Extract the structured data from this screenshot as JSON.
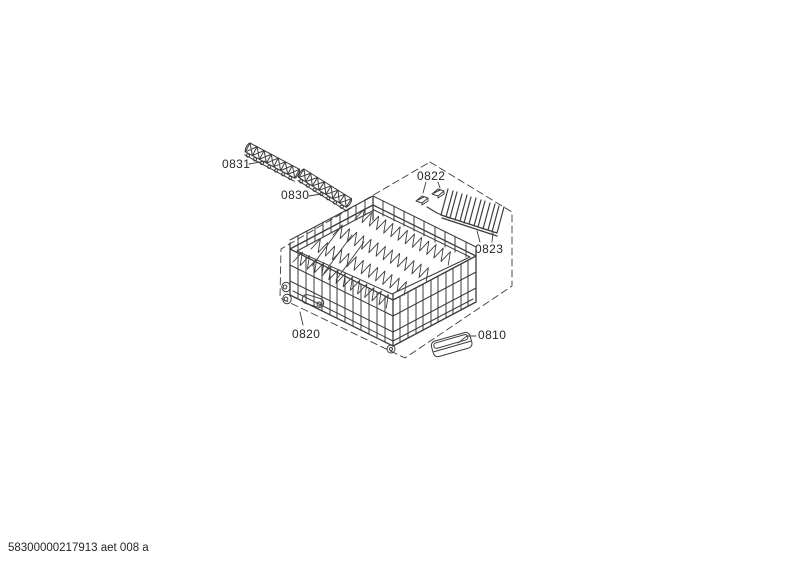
{
  "diagram": {
    "background_color": "#ffffff",
    "line_color": "#3c3c3c",
    "label_color": "#262626",
    "boundary_style": "dashed",
    "parts": [
      {
        "code": "0831"
      },
      {
        "code": "0830"
      },
      {
        "code": "0822"
      },
      {
        "code": "0823"
      },
      {
        "code": "0820"
      },
      {
        "code": "0810"
      }
    ]
  },
  "footer": {
    "document_number": "58300000217913 aet 008 a"
  }
}
